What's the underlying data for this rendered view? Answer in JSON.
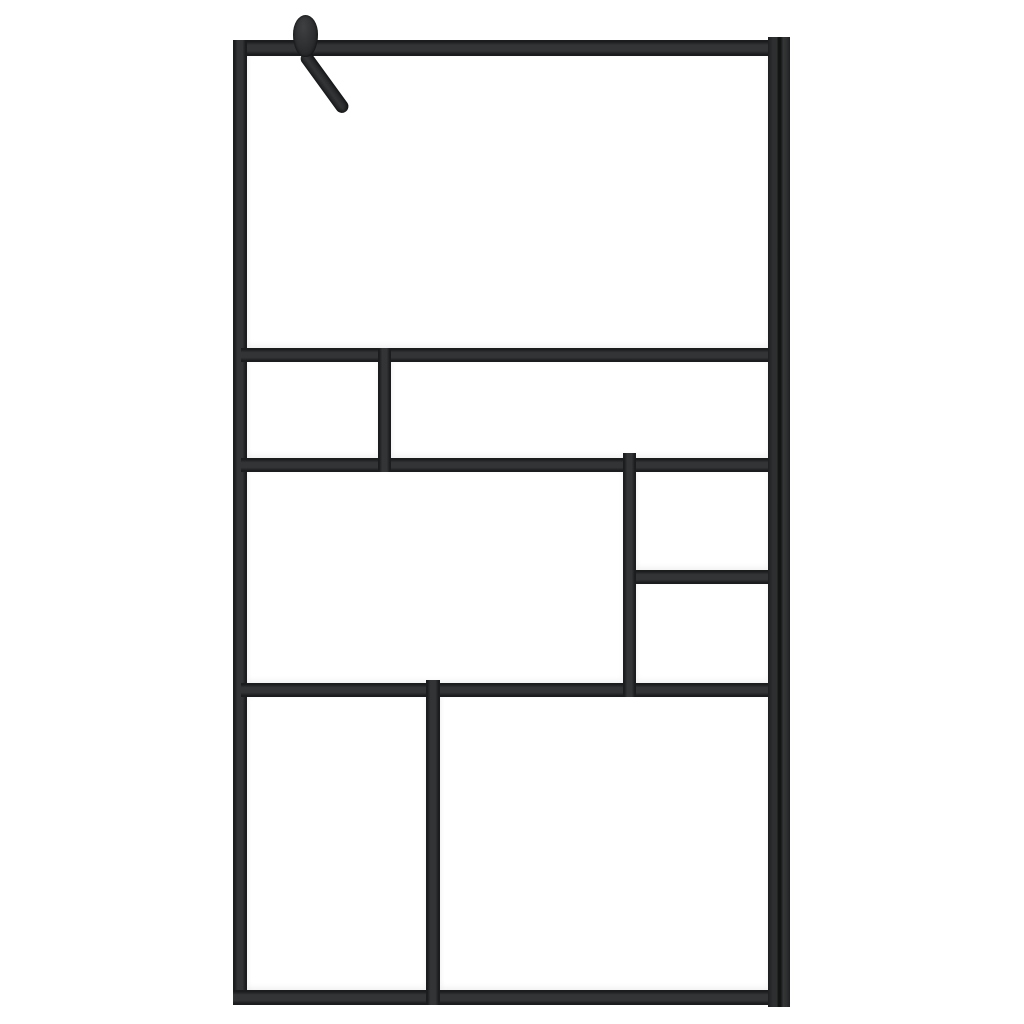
{
  "scene": {
    "type": "product-photo",
    "subject": "walk-in shower screen with black frame and clear tempered glass",
    "orientation": "portrait panel on white background"
  },
  "palette": {
    "background": "#ffffff",
    "glass": "#ffffff",
    "frame_mid": "#323435",
    "frame_edge": "#1a1c1d",
    "profile_dark": "#121414",
    "hardware": "#2c2e2f"
  },
  "glass_panes": [
    {
      "name": "pane-top",
      "x": 247,
      "y": 56,
      "w": 521,
      "h": 292
    },
    {
      "name": "pane-row2-left",
      "x": 247,
      "y": 362,
      "w": 131,
      "h": 96
    },
    {
      "name": "pane-row2-right",
      "x": 391,
      "y": 362,
      "w": 377,
      "h": 96
    },
    {
      "name": "pane-row3-left",
      "x": 247,
      "y": 472,
      "w": 376,
      "h": 211
    },
    {
      "name": "pane-row3-right-top",
      "x": 636,
      "y": 472,
      "w": 132,
      "h": 98
    },
    {
      "name": "pane-row3-right-bottom",
      "x": 636,
      "y": 584,
      "w": 132,
      "h": 99
    },
    {
      "name": "pane-row4-left",
      "x": 247,
      "y": 697,
      "w": 179,
      "h": 293
    },
    {
      "name": "pane-row4-right",
      "x": 440,
      "y": 697,
      "w": 328,
      "h": 293
    }
  ],
  "frame_members": [
    {
      "name": "top-frame-bar",
      "kind": "hbar",
      "x": 233,
      "y": 40,
      "w": 537,
      "h": 16
    },
    {
      "name": "left-frame-bar",
      "kind": "vbar",
      "x": 233,
      "y": 40,
      "w": 14,
      "h": 965
    },
    {
      "name": "bottom-frame-bar",
      "kind": "hbar",
      "x": 233,
      "y": 990,
      "w": 537,
      "h": 15
    },
    {
      "name": "divider-h1",
      "kind": "hbar",
      "x": 241,
      "y": 348,
      "w": 529,
      "h": 14
    },
    {
      "name": "divider-h2",
      "kind": "hbar",
      "x": 241,
      "y": 458,
      "w": 529,
      "h": 14
    },
    {
      "name": "divider-h3",
      "kind": "hbar",
      "x": 241,
      "y": 683,
      "w": 529,
      "h": 14
    },
    {
      "name": "divider-h-right",
      "kind": "hbar",
      "x": 629,
      "y": 570,
      "w": 141,
      "h": 14
    },
    {
      "name": "divider-v-row2",
      "kind": "vbar",
      "x": 378,
      "y": 348,
      "w": 13,
      "h": 124
    },
    {
      "name": "divider-v-row3",
      "kind": "vbar",
      "x": 623,
      "y": 453,
      "w": 13,
      "h": 244
    },
    {
      "name": "divider-v-row4",
      "kind": "vbar",
      "x": 426,
      "y": 680,
      "w": 14,
      "h": 325
    },
    {
      "name": "wall-profile",
      "kind": "profile",
      "x": 768,
      "y": 37,
      "w": 22,
      "h": 970
    }
  ],
  "hook": {
    "name": "towel-hook",
    "knob": {
      "x": 293,
      "y": 15,
      "w": 25,
      "h": 42
    },
    "arm": {
      "x": 301,
      "y": 52,
      "w": 13,
      "h": 72,
      "angle": -36
    }
  }
}
